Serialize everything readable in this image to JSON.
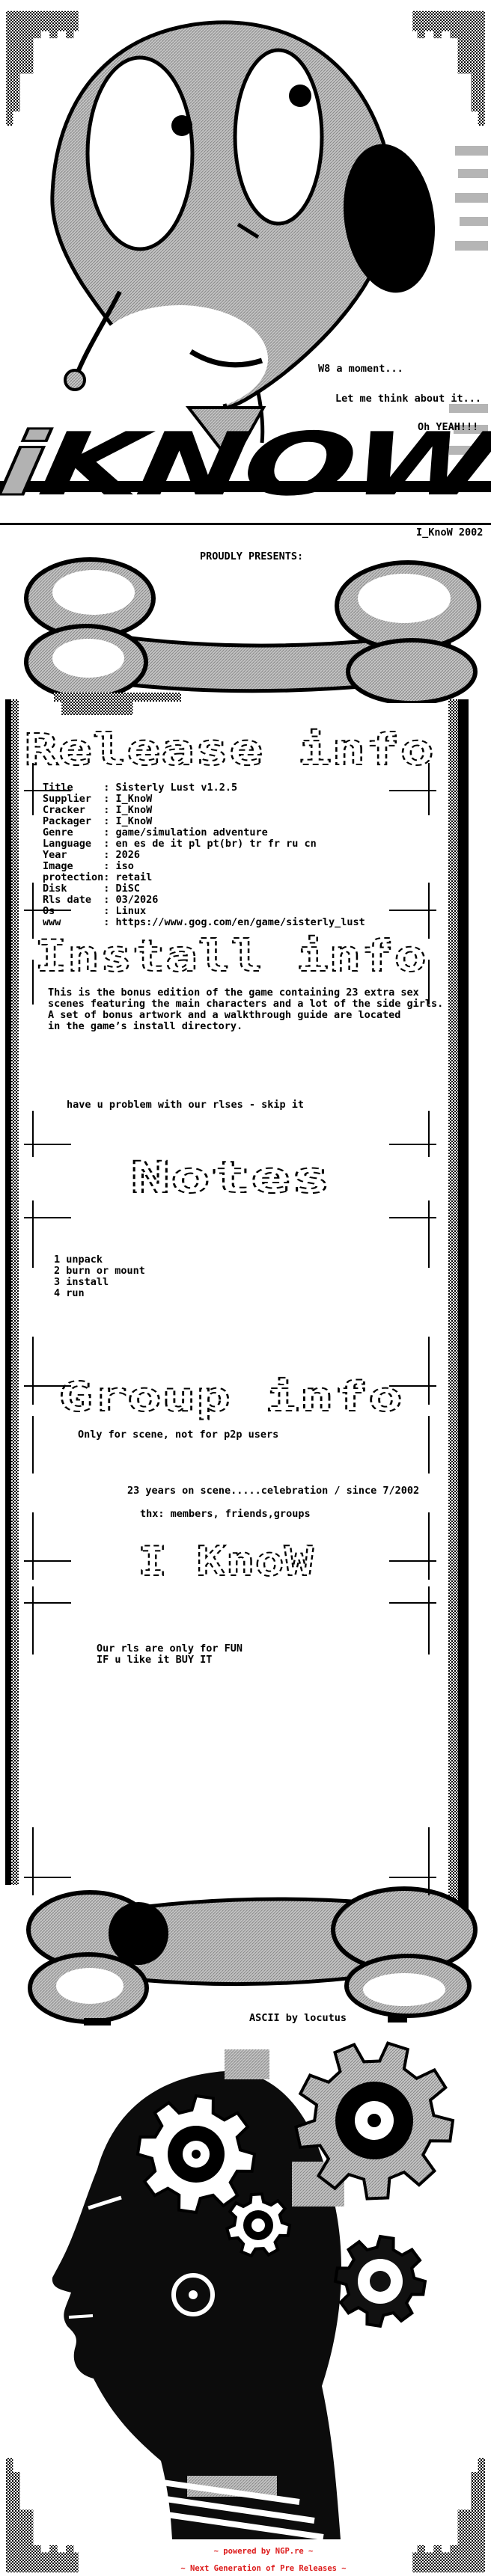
{
  "bubbles": {
    "b1": "W8 a moment...",
    "b2": "Let me think about it...",
    "b3": "Oh YEAH!!!"
  },
  "logo": {
    "i": "i",
    "know": "KNOW",
    "credit": "I_KnoW 2002",
    "presents": "PROUDLY PRESENTS:"
  },
  "release": {
    "title": "Release info",
    "rows": [
      {
        "label": "Title",
        "value": "Sisterly Lust v1.2.5"
      },
      {
        "label": "Supplier",
        "value": "I_KnoW"
      },
      {
        "label": "Cracker",
        "value": "I_KnoW"
      },
      {
        "label": "Packager",
        "value": "I_KnoW"
      },
      {
        "label": "Genre",
        "value": "game/simulation adventure"
      },
      {
        "label": "Language",
        "value": "en es de it pl pt(br) tr fr ru cn"
      },
      {
        "label": "Year",
        "value": "2026"
      },
      {
        "label": "Image",
        "value": "iso"
      },
      {
        "label": "protection",
        "value": "retail"
      },
      {
        "label": "Disk",
        "value": "DiSC"
      },
      {
        "label": "Rls date",
        "value": "03/2026"
      },
      {
        "label": "Os",
        "value": "Linux"
      },
      {
        "label": "www",
        "value": "https://www.gog.com/en/game/sisterly_lust"
      }
    ]
  },
  "install": {
    "title": "Install info",
    "lines": [
      "This is the bonus edition of the game containing 23 extra sex",
      "scenes featuring the main characters and a lot of the side girls.",
      "A set of bonus artwork and a walkthrough guide are located",
      "in the game’s install directory."
    ],
    "note": "have u problem with our rlses - skip it"
  },
  "notes": {
    "title": "Notes",
    "steps": [
      "1 unpack",
      "2 burn or mount",
      "3 install",
      "4 run"
    ]
  },
  "group": {
    "title": "Group info",
    "line1": "Only for scene, not for p2p users",
    "line2": "23 years on scene.....celebration / since 7/2002",
    "line3": "thx: members, friends,groups"
  },
  "iknow": {
    "title": "I KnoW",
    "lines": [
      "Our rls are only for FUN",
      "IF u like it BUY IT"
    ]
  },
  "credits": {
    "ascii": "ASCII by locutus"
  },
  "footer": {
    "line1": "~ powered by NGP.re ~",
    "line2": "~ Next Generation of Pre Releases ~",
    "color": "#dd1a1a"
  }
}
